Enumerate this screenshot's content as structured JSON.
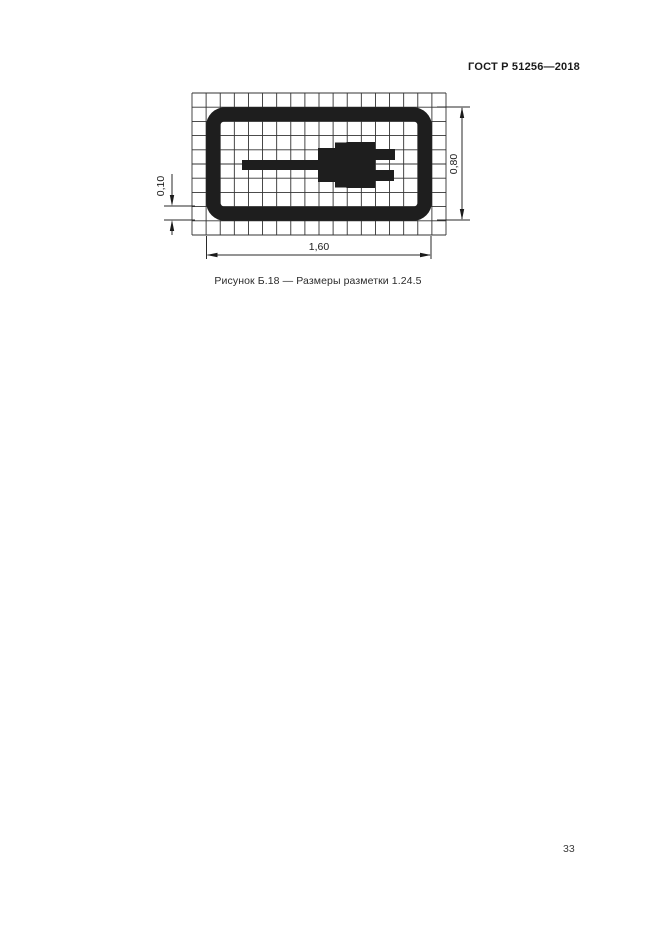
{
  "header": {
    "designation": "ГОСТ Р 51256—2018"
  },
  "figure": {
    "caption": "Рисунок Б.18 — Размеры разметки 1.24.5",
    "symbol_icon": "electric-plug-icon",
    "grid": {
      "cols": 18,
      "rows": 10
    },
    "dimensions": {
      "line_width": "0,10",
      "height": "0,80",
      "width": "1,60"
    },
    "ink_color": "#1e1e1e",
    "grid_line_color": "#333333",
    "dim_line_color": "#2a2a2a"
  },
  "footer": {
    "page_number": "33"
  }
}
